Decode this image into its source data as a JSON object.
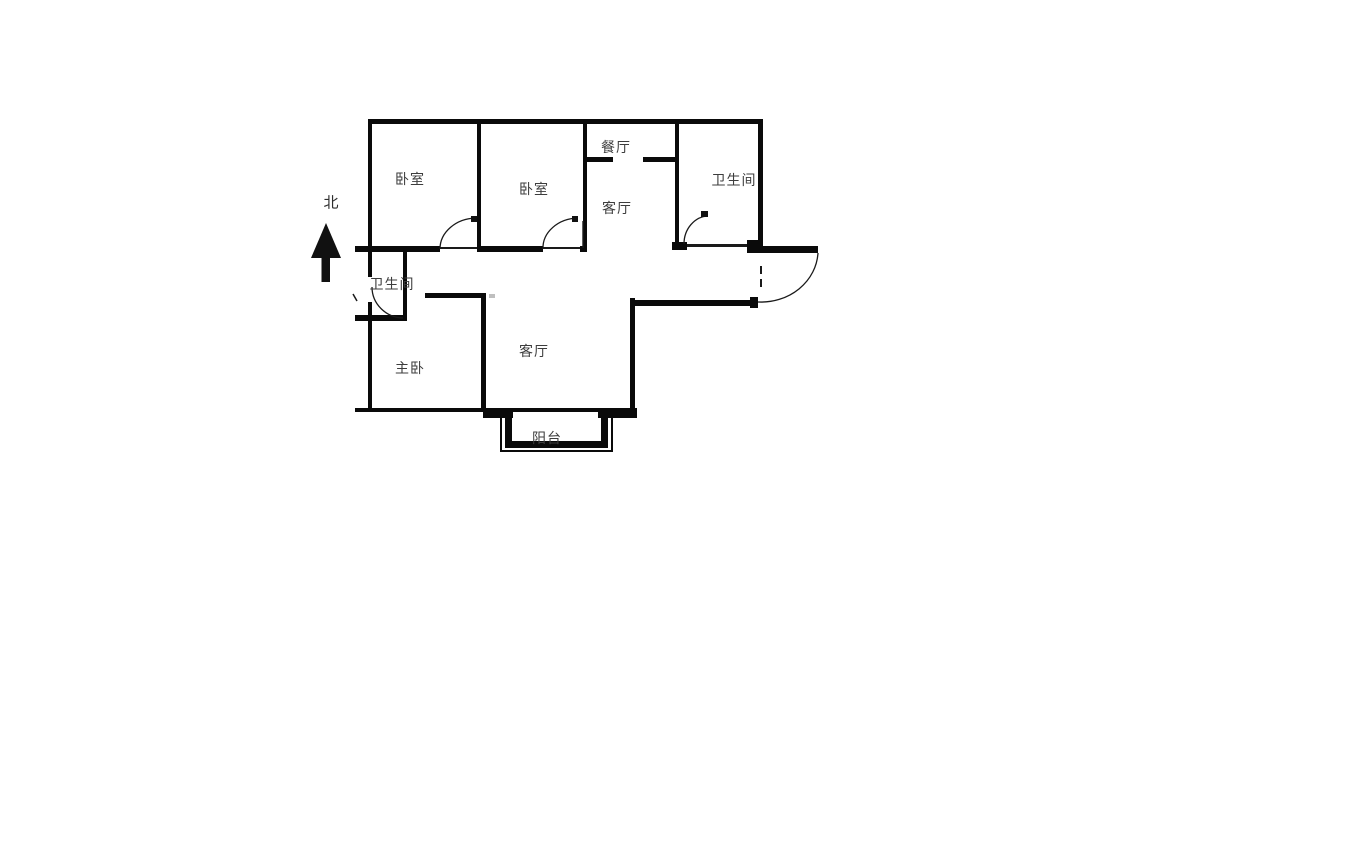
{
  "meta": {
    "type": "apartment-floor-plan",
    "background_color": "#ffffff",
    "wall_color": "#0a0a0a",
    "label_color": "#3d3d3d"
  },
  "compass": {
    "north_label": "北"
  },
  "rooms": [
    {
      "id": "bedroom-1",
      "label": "卧室"
    },
    {
      "id": "bedroom-2",
      "label": "卧室"
    },
    {
      "id": "dining-room",
      "label": "餐厅"
    },
    {
      "id": "hall",
      "label": "客厅"
    },
    {
      "id": "bathroom-right",
      "label": "卫生间"
    },
    {
      "id": "bathroom-left",
      "label": "卫生间"
    },
    {
      "id": "master-bedroom",
      "label": "主卧"
    },
    {
      "id": "living-room",
      "label": "客厅"
    },
    {
      "id": "balcony",
      "label": "阳台"
    }
  ]
}
